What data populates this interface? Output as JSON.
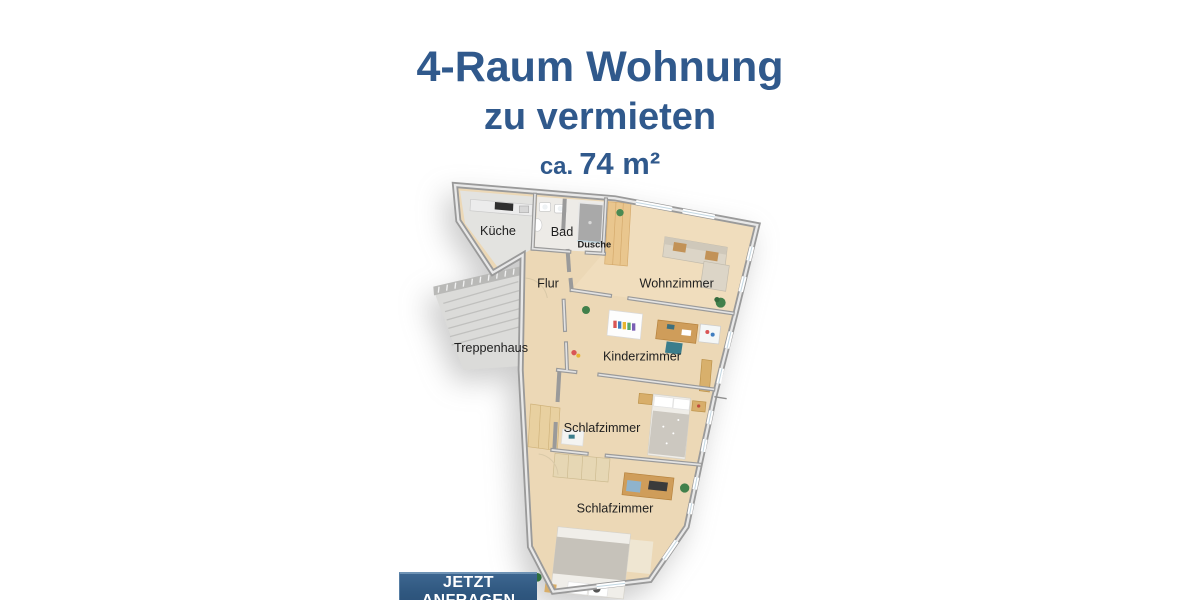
{
  "header": {
    "title": "4-Raum Wohnung",
    "subtitle": "zu vermieten",
    "area_prefix": "ca.",
    "area_value": "74 m²"
  },
  "floorplan": {
    "labels": {
      "kueche": "Küche",
      "bad": "Bad",
      "dusche": "Dusche",
      "flur": "Flur",
      "wohnzimmer": "Wohnzimmer",
      "treppenhaus": "Treppenhaus",
      "kinderzimmer": "Kinderzimmer",
      "schlafzimmer_1": "Schlafzimmer",
      "schlafzimmer_2": "Schlafzimmer"
    }
  },
  "cta": {
    "label": "JETZT ANFRAGEN"
  },
  "colors": {
    "heading_blue": "#30598c",
    "button_blue": "#2f567e",
    "button_highlight": "#6f93b5",
    "wall_gray": "#9a9a9a",
    "floor_wood": "#ecd8b6"
  }
}
